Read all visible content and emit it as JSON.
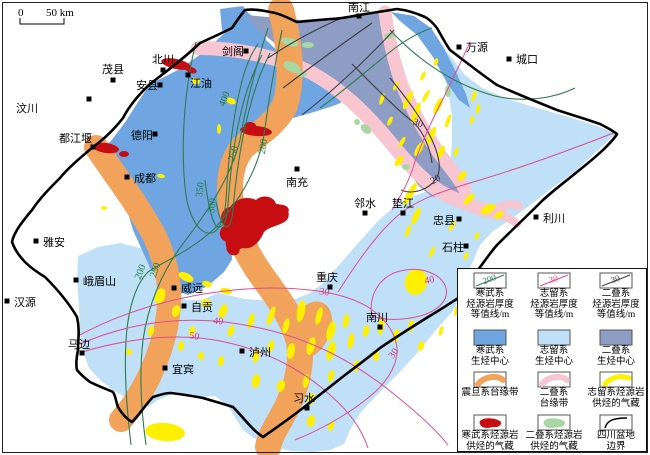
{
  "scale_bar": {
    "zero": "0",
    "label": "50 km"
  },
  "colors": {
    "cambrian_fill": "#6FA6E2",
    "silurian_fill": "#BFE0F7",
    "permian_fill": "#8E9DC3",
    "sinian_band": "#F1A35C",
    "permian_band": "#F7C6D1",
    "silurian_gas": "#FFF000",
    "cambrian_gas": "#C60D12",
    "permian_gas": "#A9D7A3",
    "cambrian_line": "#2E7B4F",
    "silurian_line": "#DC4E93",
    "permian_line": "#3C3C46",
    "basin_boundary": "#000000"
  },
  "cities": [
    {
      "name": "汶川",
      "x": 89,
      "y": 99,
      "dx": -73,
      "dy": 13
    },
    {
      "name": "茂县",
      "x": 113,
      "y": 80,
      "dx": -11,
      "dy": -7
    },
    {
      "name": "北川",
      "x": 163,
      "y": 70,
      "dx": -11,
      "dy": -7
    },
    {
      "name": "安县",
      "x": 160,
      "y": 85,
      "dx": -24,
      "dy": 4
    },
    {
      "name": "江油",
      "x": 188,
      "y": 75,
      "dx": 2,
      "dy": 12
    },
    {
      "name": "剑阁",
      "x": 246,
      "y": 51,
      "dx": -24,
      "dy": 4
    },
    {
      "name": "南江",
      "x": 359,
      "y": 16,
      "dx": -11,
      "dy": -5
    },
    {
      "name": "万源",
      "x": 459,
      "y": 47,
      "dx": 7,
      "dy": 4
    },
    {
      "name": "城口",
      "x": 509,
      "y": 59,
      "dx": 7,
      "dy": 4
    },
    {
      "name": "都江堰",
      "x": 93,
      "y": 147,
      "dx": -34,
      "dy": -5
    },
    {
      "name": "德阳",
      "x": 155,
      "y": 134,
      "dx": -24,
      "dy": 5
    },
    {
      "name": "成都",
      "x": 127,
      "y": 177,
      "dx": 7,
      "dy": 5
    },
    {
      "name": "南充",
      "x": 297,
      "y": 169,
      "dx": -11,
      "dy": 17
    },
    {
      "name": "雅安",
      "x": 36,
      "y": 241,
      "dx": 7,
      "dy": 5
    },
    {
      "name": "峨眉山",
      "x": 76,
      "y": 280,
      "dx": 7,
      "dy": 5
    },
    {
      "name": "汉源",
      "x": 7,
      "y": 301,
      "dx": 7,
      "dy": 5
    },
    {
      "name": "马边",
      "x": 82,
      "y": 353,
      "dx": -14,
      "dy": -5
    },
    {
      "name": "威远",
      "x": 174,
      "y": 288,
      "dx": 7,
      "dy": 4
    },
    {
      "name": "自贡",
      "x": 184,
      "y": 306,
      "dx": 7,
      "dy": 5
    },
    {
      "name": "宜宾",
      "x": 165,
      "y": 368,
      "dx": 7,
      "dy": 5
    },
    {
      "name": "泸州",
      "x": 242,
      "y": 351,
      "dx": 7,
      "dy": 5
    },
    {
      "name": "习水",
      "x": 307,
      "y": 408,
      "dx": -14,
      "dy": -6
    },
    {
      "name": "重庆",
      "x": 330,
      "y": 287,
      "dx": -14,
      "dy": -6
    },
    {
      "name": "南川",
      "x": 380,
      "y": 327,
      "dx": -14,
      "dy": -6
    },
    {
      "name": "邻水",
      "x": 365,
      "y": 213,
      "dx": -11,
      "dy": -6
    },
    {
      "name": "垫江",
      "x": 403,
      "y": 213,
      "dx": -11,
      "dy": -6
    },
    {
      "name": "忠县",
      "x": 459,
      "y": 219,
      "dx": -26,
      "dy": 5
    },
    {
      "name": "石柱",
      "x": 466,
      "y": 246,
      "dx": -24,
      "dy": 5
    },
    {
      "name": "利川",
      "x": 536,
      "y": 217,
      "dx": 7,
      "dy": 5
    }
  ],
  "contour_labels": [
    {
      "system": "cambrian",
      "value": "400",
      "x": 227,
      "y": 100,
      "rot": -68
    },
    {
      "system": "cambrian",
      "value": "350",
      "x": 203,
      "y": 190,
      "rot": -83
    },
    {
      "system": "cambrian",
      "value": "300",
      "x": 215,
      "y": 206,
      "rot": -83
    },
    {
      "system": "cambrian",
      "value": "250",
      "x": 236,
      "y": 154,
      "rot": -76
    },
    {
      "system": "cambrian",
      "value": "200",
      "x": 266,
      "y": 147,
      "rot": -80
    },
    {
      "system": "cambrian",
      "value": "250",
      "x": 158,
      "y": 271,
      "rot": -72
    },
    {
      "system": "cambrian",
      "value": "200",
      "x": 143,
      "y": 273,
      "rot": -68
    },
    {
      "system": "silurian",
      "value": "50",
      "x": 194,
      "y": 339,
      "rot": 8
    },
    {
      "system": "silurian",
      "value": "40",
      "x": 218,
      "y": 324,
      "rot": 5
    },
    {
      "system": "silurian",
      "value": "30",
      "x": 324,
      "y": 295,
      "rot": 8
    },
    {
      "system": "silurian",
      "value": "40",
      "x": 430,
      "y": 283,
      "rot": -12
    },
    {
      "system": "silurian",
      "value": "30",
      "x": 396,
      "y": 355,
      "rot": -55
    },
    {
      "system": "permian",
      "value": "30",
      "x": 417,
      "y": 126,
      "rot": 20
    },
    {
      "system": "permian",
      "value": "20",
      "x": 437,
      "y": 182,
      "rot": -30
    }
  ],
  "legend": {
    "items": [
      {
        "kind": "contour",
        "color_key": "cambrian_line",
        "value": "200",
        "lines": [
          "寒武系",
          "烃源岩厚度",
          "等值线/m"
        ]
      },
      {
        "kind": "contour",
        "color_key": "silurian_line",
        "value": "30",
        "lines": [
          "志留系",
          "烃源岩厚度",
          "等值线/m"
        ]
      },
      {
        "kind": "contour",
        "color_key": "permian_line",
        "value": "30",
        "lines": [
          "二叠系",
          "烃源岩厚度",
          "等值线/m"
        ]
      },
      {
        "kind": "fill",
        "color_key": "cambrian_fill",
        "lines": [
          "寒武系",
          "生烃中心"
        ]
      },
      {
        "kind": "fill",
        "color_key": "silurian_fill",
        "lines": [
          "志留系",
          "生烃中心"
        ]
      },
      {
        "kind": "fill",
        "color_key": "permian_fill",
        "lines": [
          "二叠系",
          "生烃中心"
        ]
      },
      {
        "kind": "band",
        "color_key": "sinian_band",
        "lines": [
          "震旦系台缘带"
        ]
      },
      {
        "kind": "band",
        "color_key": "permian_band",
        "lines": [
          "二叠系",
          "台缘带"
        ]
      },
      {
        "kind": "gasband",
        "color_key": "silurian_gas",
        "lines": [
          "志留系烃源岩",
          "供烃的气藏"
        ]
      },
      {
        "kind": "blob",
        "color_key": "cambrian_gas",
        "lines": [
          "寒武系烃源岩",
          "供烃的气藏"
        ]
      },
      {
        "kind": "blob",
        "color_key": "permian_gas",
        "lines": [
          "二叠系烃源岩",
          "供烃的气藏"
        ]
      },
      {
        "kind": "line",
        "color_key": "basin_boundary",
        "lines": [
          "四川盆地",
          "边界"
        ]
      }
    ]
  }
}
